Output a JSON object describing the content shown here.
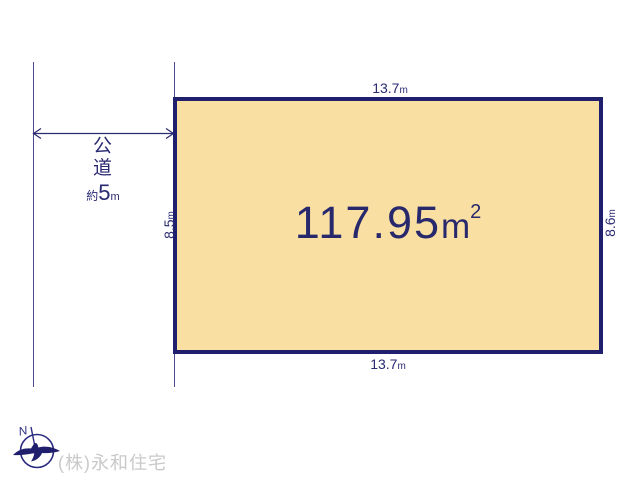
{
  "diagram": {
    "type": "land-plot-layout",
    "background_color": "#ffffff"
  },
  "parcel": {
    "area_value": "117.95",
    "area_unit": "m",
    "area_unit_sup": "2",
    "fill_color": "#f9dfa1",
    "border_color": "#1f1f6d"
  },
  "dimensions": {
    "top": {
      "value": "13.7",
      "unit": "m"
    },
    "bottom": {
      "value": "13.7",
      "unit": "m"
    },
    "left": {
      "value": "8.5",
      "unit": "m"
    },
    "right": {
      "value": "8.6",
      "unit": "m"
    }
  },
  "road": {
    "chars": [
      "公",
      "道"
    ],
    "width_prefix": "約",
    "width_value": "5",
    "width_unit": "m"
  },
  "compass": {
    "icon": "north-compass-icon",
    "letter": "N",
    "color": "#2a2a80"
  },
  "footer": {
    "company": "(株)永和住宅",
    "company_color": "#c9c9c9"
  },
  "colors": {
    "line_navy": "#2a2a72",
    "extension_line": "#4a4a93",
    "text_navy": "#28286d"
  }
}
